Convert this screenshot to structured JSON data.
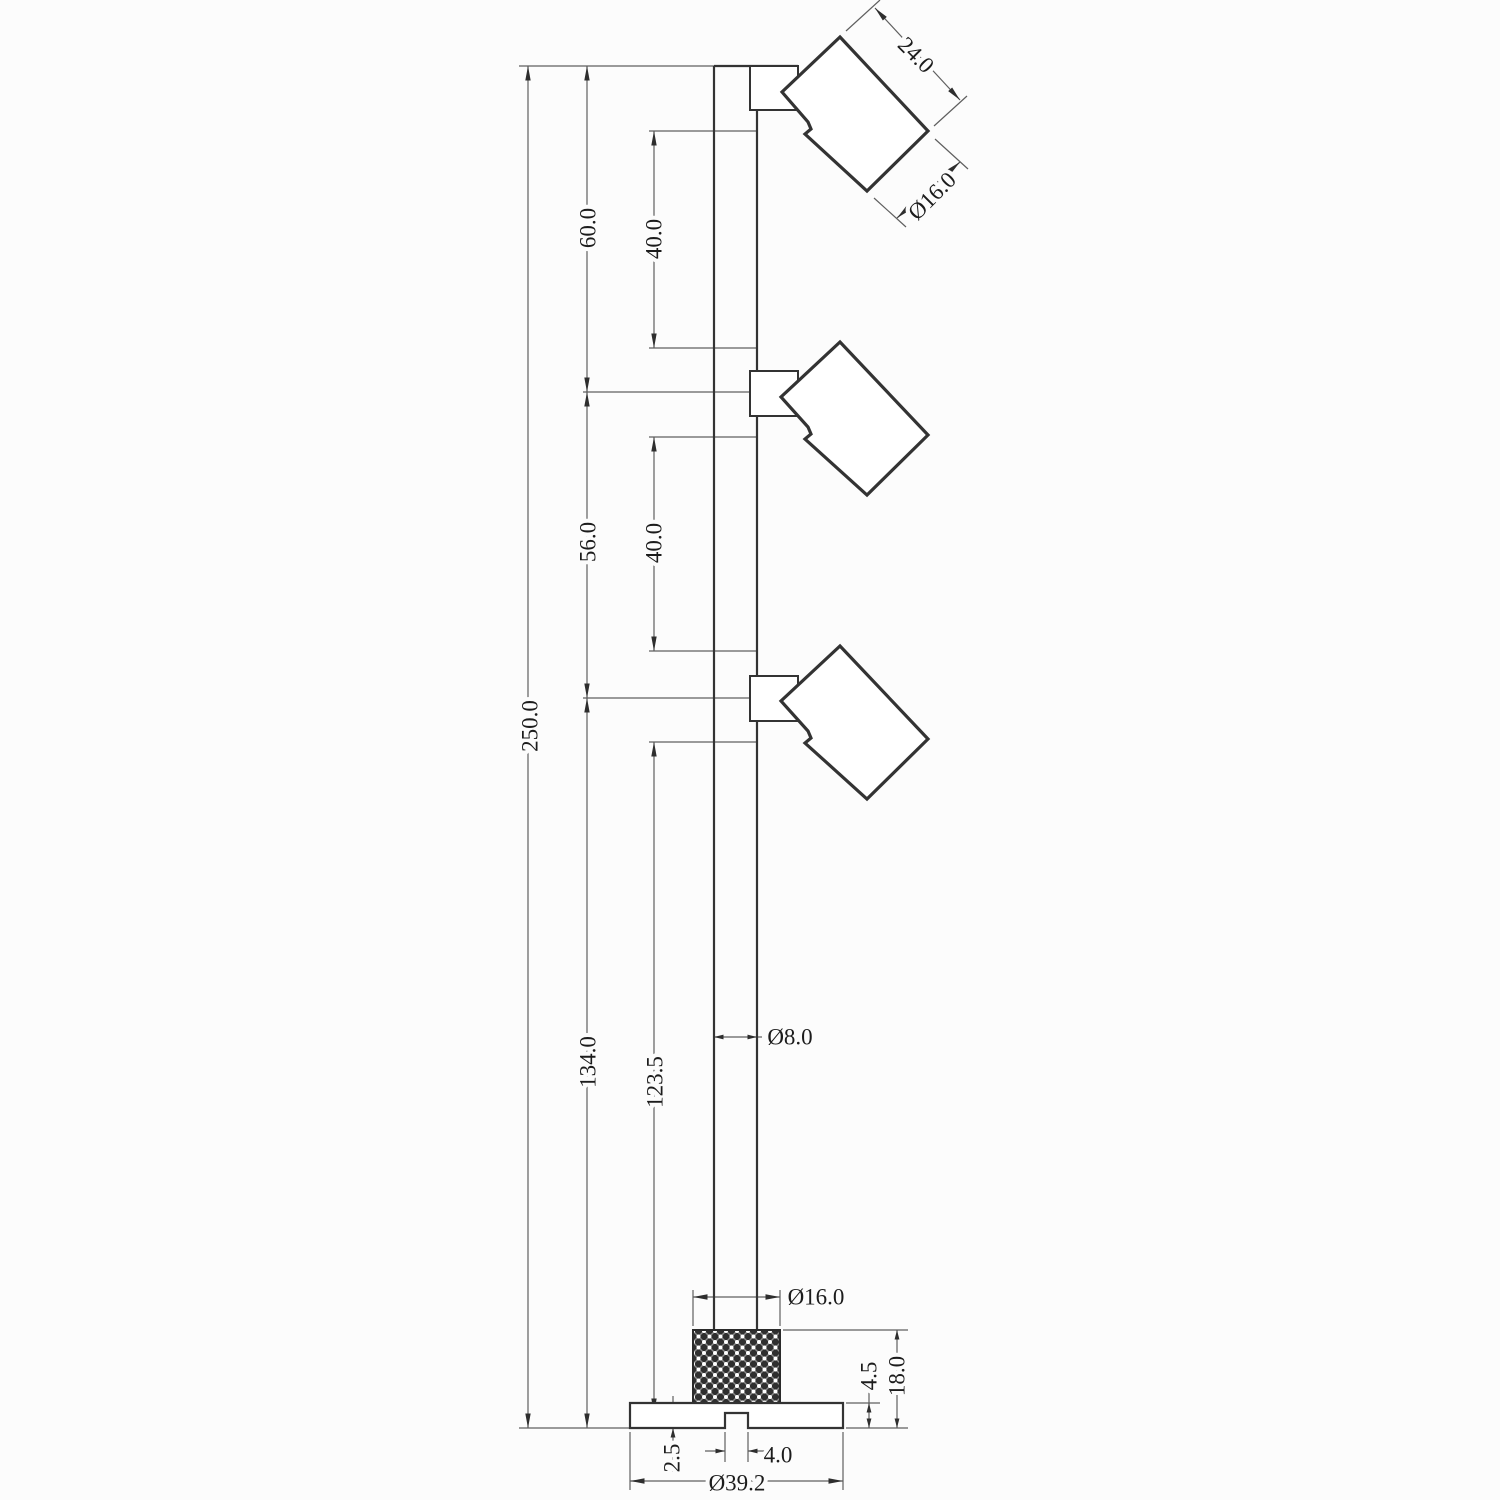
{
  "drawing": {
    "type": "technical-dimension-drawing",
    "subject": "three-head spotlight pole lamp, side elevation",
    "units_implied": "mm"
  },
  "dims": {
    "overall_height": "250.0",
    "top_section": "60.0",
    "mid_section": "56.0",
    "bottom_section": "134.0",
    "head_gap_top": "40.0",
    "head_gap_mid": "40.0",
    "pole_exposed": "123.5",
    "pole_diameter": "Ø8.0",
    "head_length": "24.0",
    "head_diameter": "Ø16.0",
    "knurl_diameter": "Ø16.0",
    "plate_thickness": "4.5",
    "base_height": "18.0",
    "plate_step": "2.5",
    "slot_width": "4.0",
    "base_diameter": "Ø39.2"
  },
  "colors": {
    "bg": "#fcfcfc",
    "outline": "#333333",
    "thin": "#5f5f5f",
    "text": "#1c1c1c",
    "knurl-dark": "#2f2f2f",
    "knurl-line": "#8a8a8a",
    "knurl-dot": "#ffffff"
  }
}
